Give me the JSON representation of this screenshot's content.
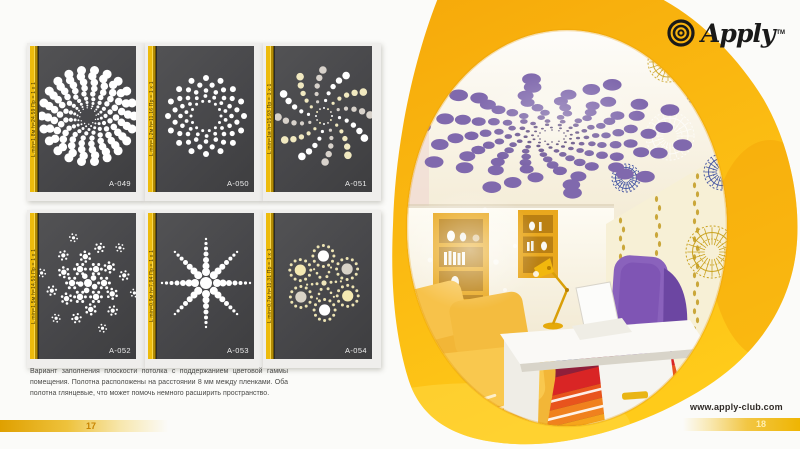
{
  "logo": {
    "name": "Apply",
    "tm": "TM",
    "icon": "concentric-rings-icon"
  },
  "website": "www.apply-club.com",
  "page_numbers": {
    "left": "17",
    "right": "18"
  },
  "description": "Вариант заполнения плоскости потолка с поддержанием цветовой гаммы помещения. Полотна расположены на расстоянии 8 мм между пленками. Оба полотна глянцевые, что может помочь немного расширить пространство.",
  "cards": [
    {
      "code": "A-049",
      "spec": "L min=1,8м  h=24,59  Пр = 1 х 1",
      "pattern": "dense-mandala"
    },
    {
      "code": "A-050",
      "spec": "L min=1,2м  h=11,16  Пр = 1 х 1",
      "pattern": "ring-flower"
    },
    {
      "code": "A-051",
      "spec": "L min=1м  h=15,93  Пр = 1 х 1",
      "pattern": "pinwheel-rays"
    },
    {
      "code": "A-052",
      "spec": "L min=1,5м  h=14,51  Пр = 1 х 1",
      "pattern": "spiral-clusters"
    },
    {
      "code": "A-053",
      "spec": "L min=0,9м  h=7,94  Пр = 1 х 1",
      "pattern": "starburst"
    },
    {
      "code": "A-054",
      "spec": "L min=0,7м  h=11,31  Пр = 1 х 1",
      "pattern": "petal-flower"
    }
  ],
  "colors": {
    "brand_yellow": "#F9B70D",
    "card_panel": "#47474A",
    "stripe_gold": "#EDBB0C",
    "dot_white": "#FFFFFF",
    "ceiling_purple": "#8069AD",
    "sofa_yellow": "#F4BC3F",
    "chair_purple": "#8A62BC",
    "rug_red": "#D92525"
  }
}
